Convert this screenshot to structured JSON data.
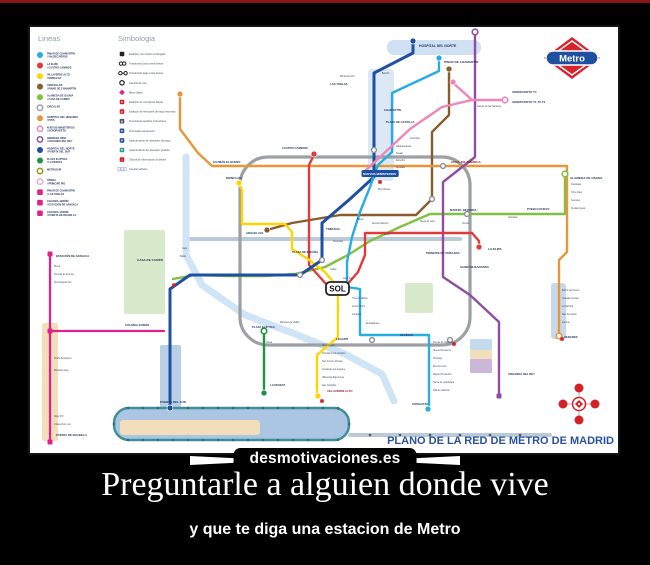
{
  "page": {
    "background": "#000000",
    "top_bar_color": "#8a1418"
  },
  "poster": {
    "watermark": "desmotivaciones.es",
    "caption_title": "Preguntarle a alguien donde vive",
    "caption_subtitle": "y que te diga una estacion de Metro"
  },
  "map": {
    "title": "PLANO DE LA RED DE METRO DE MADRID",
    "title_color": "#2a52a0",
    "logo_text": "Metro",
    "sol_label": "SOL",
    "legend_lines_header": "Lineas",
    "legend_symbols_header": "Simbologia",
    "legend_lines": [
      {
        "shape": "circle",
        "color": "#29ace3",
        "label": "PINAR DE CHAMARTÍN / VALDECARROS"
      },
      {
        "shape": "circle",
        "color": "#e23a3c",
        "label": "LA ELIPA / CUATRO CAMINOS"
      },
      {
        "shape": "circle",
        "color": "#ffd500",
        "label": "VILLAVERDE ALTO / MONCLOA"
      },
      {
        "shape": "circle",
        "color": "#8a5b2c",
        "label": "ARGÜELLES / PINAR DE CHAMARTÍN"
      },
      {
        "shape": "circle",
        "color": "#7fc241",
        "label": "ALAMEDA DE OSUNA / CASA DE CAMPO"
      },
      {
        "shape": "ring",
        "color": "#9ca0a3",
        "label": "CIRCULAR"
      },
      {
        "shape": "circle",
        "color": "#e8963c",
        "label": "HOSPITAL DEL HENARES / PITIS"
      },
      {
        "shape": "ring",
        "color": "#ef86b7",
        "label": "NUEVOS MINISTERIOS / AEROPUERTO"
      },
      {
        "shape": "ring",
        "color": "#8f4e9f",
        "label": "HERRERA ORIA / ARGANDA DEL REY"
      },
      {
        "shape": "circle",
        "color": "#1d50a1",
        "label": "HOSPITAL DEL NORTE / PUERTA DEL SUR"
      },
      {
        "shape": "circle",
        "color": "#1f9247",
        "label": "PLAZA ELÍPTICA / LA PESETA"
      },
      {
        "shape": "ring",
        "color": "#9b9013",
        "label": "METROSUR"
      },
      {
        "shape": "ring",
        "color": "#f0a8c8",
        "label": "ÓPERA / PRÍNCIPE PÍO"
      },
      {
        "shape": "square",
        "color": "#e0218a",
        "label": "PINAR DE CHAMARTÍN / LAS TABLAS"
      },
      {
        "shape": "square",
        "color": "#e0218a",
        "label": "COLONIA JARDÍN / ESTACIÓN DE ARAVACA"
      },
      {
        "shape": "square",
        "color": "#e0218a",
        "label": "COLONIA JARDÍN / PUERTA DE BOADILLA"
      }
    ],
    "legend_symbols": [
      {
        "icon": "blk",
        "color": "#222222",
        "label": "Estación con horario restringido"
      },
      {
        "icon": "xshort",
        "color": "#222222",
        "label": "Transbordo corto entre líneas"
      },
      {
        "icon": "xlong",
        "color": "#222222",
        "label": "Transbordo largo entre líneas"
      },
      {
        "icon": "swap",
        "color": "#222222",
        "label": "Cambio de tren"
      },
      {
        "icon": "ml",
        "color": "#e0218a",
        "label": "Metro ligero"
      },
      {
        "icon": "cerc",
        "color": "#d42027",
        "label": "Estación de Cercanías-Renfe"
      },
      {
        "icon": "rail",
        "color": "#d42027",
        "label": "Estación de ferrocarril de largo recorrido"
      },
      {
        "icon": "bus",
        "color": "#445566",
        "label": "Terminal de autobús interurbano"
      },
      {
        "icon": "air",
        "color": "#2a52a0",
        "label": "Terminales aeropuerto"
      },
      {
        "icon": "park",
        "color": "#2a52a0",
        "label": "Aparcamiento de disuasión de pago"
      },
      {
        "icon": "park",
        "color": "#2f9e8f",
        "label": "Aparcamiento de disuasión gratuito"
      },
      {
        "icon": "info",
        "color": "#d42027",
        "label": "Oficina de información al cliente"
      },
      {
        "icon": "tarif",
        "color": "#a9b2bf",
        "label": "Cambio tarifario"
      }
    ],
    "areas": [
      {
        "x": 338,
        "y": 42,
        "w": 26,
        "h": 112,
        "rx": 4,
        "fill": "#dce8f5"
      },
      {
        "x": 357,
        "y": 13,
        "w": 94,
        "h": 15,
        "rx": 7,
        "fill": "#cfe0f2"
      },
      {
        "x": 94,
        "y": 203,
        "w": 41,
        "h": 84,
        "rx": 2,
        "fill": "#d9e9cb"
      },
      {
        "x": 375,
        "y": 256,
        "w": 28,
        "h": 30,
        "rx": 2,
        "fill": "#d9e9cb"
      },
      {
        "x": 521,
        "y": 256,
        "w": 15,
        "h": 56,
        "rx": 3,
        "fill": "#c6daee"
      },
      {
        "x": 440,
        "y": 312,
        "w": 22,
        "h": 11,
        "rx": 1,
        "fill": "#c6daee"
      },
      {
        "x": 440,
        "y": 323,
        "w": 22,
        "h": 9,
        "rx": 1,
        "fill": "#f3debc"
      },
      {
        "x": 440,
        "y": 332,
        "w": 22,
        "h": 14,
        "rx": 1,
        "fill": "#cbb8d8"
      },
      {
        "x": 12,
        "y": 296,
        "w": 16,
        "h": 118,
        "rx": 2,
        "fill": "#f3debc"
      },
      {
        "x": 130,
        "y": 318,
        "w": 21,
        "h": 64,
        "rx": 2,
        "fill": "#b8cfe6"
      },
      {
        "x": 84,
        "y": 381,
        "w": 235,
        "h": 32,
        "rx": 15,
        "fill": "#abc6e2",
        "stroke": "#3f8e99",
        "sw": 2.5
      },
      {
        "x": 90,
        "y": 393,
        "w": 140,
        "h": 15,
        "rx": 3,
        "fill": "#f3debc"
      }
    ],
    "lines": [
      {
        "color": "#bcc9d8",
        "width": 4,
        "points": "160,212 430,212"
      },
      {
        "color": "#bcc9d8",
        "width": 4,
        "points": "320,408 520,408"
      },
      {
        "color": "#cfe4f4",
        "width": 7,
        "points": "156,130 156,228 172,258 215,288 265,307 315,327 352,347 364,374"
      },
      {
        "rect": [
          210,
          130,
          230,
          188
        ],
        "rx": 28,
        "color": "#9ca0a3",
        "width": 3.2
      },
      {
        "color": "#7fc241",
        "width": 2.4,
        "points": "535,148 535,187 437,187 400,187 370,200 340,214 318,228 295,240 265,247 235,249 200,249 165,248 143,252"
      },
      {
        "color": "#8a5b2c",
        "width": 2.4,
        "points": "419,43 419,88 402,105 402,172 386,188 310,188 262,196 237,203"
      },
      {
        "color": "#e8963c",
        "width": 2.4,
        "points": "150,68 150,102 168,126 182,139 537,139 537,225 529,233 529,308"
      },
      {
        "color": "#8f4e9f",
        "width": 2.4,
        "points": "445,5 445,130 413,155 413,250 440,268 469,295 469,368"
      },
      {
        "color": "#e23a3c",
        "width": 2.4,
        "points": "284,128 279,138 279,238 297,258 315,260 328,245 335,228 335,206 442,206 449,214 449,220"
      },
      {
        "color": "#ffd500",
        "width": 2.4,
        "points": "209,157 212,163 212,197 255,197 262,205 262,222 278,232 295,245 305,257 308,268 308,310 287,328 287,368"
      },
      {
        "color": "#1d50a1",
        "width": 3,
        "points": "383,15 383,26 344,46 344,150 320,172 292,196 292,233 270,248 160,248 140,262 140,381"
      },
      {
        "color": "#29ace3",
        "width": 2.4,
        "points": "409,32 409,44 362,66 362,125 348,138 340,160 330,185 322,210 317,235 317,260 330,262 330,308 399,308 399,381"
      },
      {
        "color": "#ef86b7",
        "width": 2.4,
        "points": "334,145 380,102 412,80 442,73 475,73"
      },
      {
        "color": "#ef86b7",
        "width": 2.4,
        "points": "442,73 430,62 423,56"
      },
      {
        "color": "#1f9247",
        "width": 2.4,
        "points": "234,305 234,365"
      },
      {
        "color": "#e0218a",
        "width": 2.2,
        "points": "20,228 20,415"
      },
      {
        "color": "#e0218a",
        "width": 2.2,
        "points": "20,304 134,304"
      }
    ],
    "markers": [
      {
        "x": 383,
        "y": 14,
        "type": "dot",
        "color": "#1d50a1"
      },
      {
        "x": 409,
        "y": 31,
        "type": "dot",
        "color": "#29ace3"
      },
      {
        "x": 419,
        "y": 42,
        "type": "dot",
        "color": "#8a5b2c"
      },
      {
        "x": 445,
        "y": 5,
        "type": "ring",
        "color": "#8f4e9f"
      },
      {
        "x": 150,
        "y": 67,
        "type": "dot",
        "color": "#e8963c"
      },
      {
        "x": 535,
        "y": 147,
        "type": "ring",
        "color": "#7fc241"
      },
      {
        "x": 475,
        "y": 73,
        "type": "ring",
        "color": "#ef86b7"
      },
      {
        "x": 423,
        "y": 55,
        "type": "dot",
        "color": "#ef86b7"
      },
      {
        "x": 449,
        "y": 220,
        "type": "dot",
        "color": "#e23a3c"
      },
      {
        "x": 284,
        "y": 127,
        "type": "dot",
        "color": "#e23a3c"
      },
      {
        "x": 209,
        "y": 156,
        "type": "dot",
        "color": "#ffd500"
      },
      {
        "x": 237,
        "y": 203,
        "type": "dot",
        "color": "#8a5b2c"
      },
      {
        "x": 288,
        "y": 369,
        "type": "dot",
        "color": "#ffd500"
      },
      {
        "x": 398,
        "y": 382,
        "type": "dot",
        "color": "#29ace3"
      },
      {
        "x": 234,
        "y": 304,
        "type": "ring",
        "color": "#1f9247"
      },
      {
        "x": 234,
        "y": 366,
        "type": "dot",
        "color": "#1f9247"
      },
      {
        "x": 469,
        "y": 369,
        "type": "square",
        "color": "#8f4e9f"
      },
      {
        "x": 529,
        "y": 309,
        "type": "ring",
        "color": "#e8963c"
      },
      {
        "x": 140,
        "y": 381,
        "type": "dot",
        "color": "#1d50a1"
      },
      {
        "x": 20,
        "y": 227,
        "type": "square",
        "color": "#e0218a"
      },
      {
        "x": 20,
        "y": 304,
        "type": "square",
        "color": "#e0218a"
      },
      {
        "x": 20,
        "y": 415,
        "type": "square",
        "color": "#e0218a"
      },
      {
        "x": 344,
        "y": 123,
        "type": "xfer"
      },
      {
        "x": 402,
        "y": 172,
        "type": "xfer"
      },
      {
        "x": 437,
        "y": 187,
        "type": "xfer"
      },
      {
        "x": 413,
        "y": 139,
        "type": "xfer"
      },
      {
        "x": 342,
        "y": 313,
        "type": "xfer"
      },
      {
        "x": 420,
        "y": 313,
        "type": "xfer"
      },
      {
        "x": 292,
        "y": 233,
        "type": "xfer"
      },
      {
        "x": 270,
        "y": 248,
        "type": "xfer"
      },
      {
        "x": 340,
        "y": 408,
        "type": "mini",
        "color": "#44586e"
      },
      {
        "x": 370,
        "y": 408,
        "type": "mini",
        "color": "#44586e"
      },
      {
        "x": 400,
        "y": 408,
        "type": "mini",
        "color": "#44586e"
      },
      {
        "x": 430,
        "y": 408,
        "type": "mini",
        "color": "#44586e"
      },
      {
        "x": 460,
        "y": 408,
        "type": "mini",
        "color": "#44586e"
      },
      {
        "x": 490,
        "y": 408,
        "type": "mini",
        "color": "#44586e"
      },
      {
        "x": 350,
        "y": 155,
        "type": "csq",
        "color": "#d42027"
      },
      {
        "x": 424,
        "y": 317,
        "type": "csq",
        "color": "#d42027"
      },
      {
        "x": 144,
        "y": 258,
        "type": "csq",
        "color": "#d42027"
      },
      {
        "x": 292,
        "y": 374,
        "type": "csq",
        "color": "#d42027"
      },
      {
        "x": 532,
        "y": 312,
        "type": "csq",
        "color": "#d42027"
      }
    ],
    "capsule_dots": {
      "y_top": 381,
      "y_bottom": 413,
      "x_start": 98,
      "x_end": 308,
      "step": 15,
      "color": "#2b6e78",
      "ends": [
        [
          84,
          397
        ],
        [
          319,
          397
        ]
      ]
    },
    "stations": [
      {
        "x": 389,
        "y": 20,
        "t": "HOSPITAL DEL NORTE",
        "s": 3.4
      },
      {
        "x": 414,
        "y": 36,
        "t": "PINAR DE CHAMARTÍN"
      },
      {
        "x": 300,
        "y": 58,
        "t": "LAS TABLAS",
        "s": 2.8
      },
      {
        "x": 354,
        "y": 84,
        "t": "CHAMARTÍN",
        "s": 2.8
      },
      {
        "x": 356,
        "y": 96,
        "t": "PLAZA DE CASTILLA",
        "s": 2.8
      },
      {
        "x": 482,
        "y": 66,
        "t": "AEROPUERTO T4",
        "s": 2.9
      },
      {
        "x": 482,
        "y": 76,
        "t": "AEROPUERTO T1-T2-T3",
        "s": 2.9
      },
      {
        "x": 333,
        "y": 148,
        "t": "NUEVOS MINISTERIOS",
        "s": 3,
        "badge": true
      },
      {
        "x": 421,
        "y": 136,
        "t": "AVDA. DE AMÉRICA",
        "c": "#8a1a1a"
      },
      {
        "x": 540,
        "y": 152,
        "t": "ALAMEDA DE OSUNA"
      },
      {
        "x": 497,
        "y": 183,
        "t": "PUEBLO NUEVO",
        "s": 2.8
      },
      {
        "x": 420,
        "y": 184,
        "t": "MANUEL BECERRA",
        "s": 2.8
      },
      {
        "x": 458,
        "y": 223,
        "t": "LA ELIPA"
      },
      {
        "x": 396,
        "y": 227,
        "t": "PRÍNCIPE DE VERGARA",
        "s": 2.9
      },
      {
        "x": 430,
        "y": 241,
        "t": "SAINZ DE BARANDA",
        "s": 2.9
      },
      {
        "x": 252,
        "y": 122,
        "t": "CUATRO CAMINOS",
        "s": 2.8
      },
      {
        "x": 183,
        "y": 136,
        "t": "GUZMÁN EL BUENO",
        "s": 2.8
      },
      {
        "x": 196,
        "y": 152,
        "t": "MONCLOA"
      },
      {
        "x": 216,
        "y": 207,
        "t": "ARGÜELLES",
        "s": 2.8
      },
      {
        "x": 262,
        "y": 226,
        "t": "PLAZA DE ESPAÑA",
        "s": 2.8
      },
      {
        "x": 296,
        "y": 203,
        "t": "TRIBUNAL",
        "s": 2.8
      },
      {
        "x": 107,
        "y": 234,
        "t": "CASA DE CAMPO"
      },
      {
        "x": 95,
        "y": 299,
        "t": "COLONIA JARDÍN",
        "s": 2.8
      },
      {
        "x": 26,
        "y": 230,
        "t": "ESTACIÓN DE ARAVACA",
        "s": 2.8
      },
      {
        "x": 26,
        "y": 409,
        "t": "PUERTA DE BOADILLA",
        "s": 2.8
      },
      {
        "x": 130,
        "y": 376,
        "t": "PUERTA DEL SUR",
        "s": 3
      },
      {
        "x": 297,
        "y": 365,
        "t": "VILLAVERDE ALTO",
        "s": 2.8,
        "c": "#8a1a1a"
      },
      {
        "x": 240,
        "y": 359,
        "t": "LA PESETA",
        "s": 2.8
      },
      {
        "x": 478,
        "y": 348,
        "t": "ARGANDA DEL REY",
        "s": 2.8
      },
      {
        "x": 534,
        "y": 311,
        "t": "HENARES",
        "s": 2.8
      },
      {
        "x": 370,
        "y": 309,
        "t": "PACÍFICO",
        "s": 2.8
      },
      {
        "x": 306,
        "y": 313,
        "t": "LEGAZPI",
        "s": 2.8
      },
      {
        "x": 222,
        "y": 301,
        "t": "PLAZA ELÍPTICA",
        "s": 2.8
      },
      {
        "x": 382,
        "y": 378,
        "t": "CONGOSTO",
        "s": 2.8
      }
    ],
    "minor_stations": [
      [
        366,
        120,
        "Valdeacederas"
      ],
      [
        366,
        127,
        "Tetuán"
      ],
      [
        366,
        134,
        "Estrecho"
      ],
      [
        366,
        141,
        "Alvarado"
      ],
      [
        348,
        163,
        "Ríos Rosas"
      ],
      [
        327,
        193,
        "Bilbao"
      ],
      [
        303,
        215,
        "Noviciado"
      ],
      [
        300,
        243,
        "Callao"
      ],
      [
        313,
        252,
        "Gran Vía"
      ],
      [
        342,
        197,
        "Alonso Martínez"
      ],
      [
        354,
        208,
        "Colón"
      ],
      [
        390,
        195,
        "Diego de León"
      ],
      [
        432,
        197,
        "Ventas"
      ],
      [
        478,
        191,
        "Quintana"
      ],
      [
        541,
        158,
        "Canillejas"
      ],
      [
        541,
        166,
        "Torre Arias"
      ],
      [
        541,
        174,
        "Suanzes"
      ],
      [
        541,
        182,
        "Ciudad Lineal"
      ],
      [
        322,
        272,
        "Tirso de Molina"
      ],
      [
        322,
        280,
        "Antón Martín"
      ],
      [
        322,
        288,
        "Lavapiés"
      ],
      [
        336,
        297,
        "Embajadores"
      ],
      [
        403,
        316,
        "Puente de Vallecas"
      ],
      [
        403,
        324,
        "Nueva Numancia"
      ],
      [
        403,
        332,
        "Portazgo"
      ],
      [
        403,
        340,
        "Buenos Aires"
      ],
      [
        403,
        348,
        "Miguel Hernández"
      ],
      [
        403,
        356,
        "Sierra de Guadalupe"
      ],
      [
        403,
        364,
        "Villa de Vallecas"
      ],
      [
        292,
        319,
        "Almendrales"
      ],
      [
        292,
        327,
        "Hospital 12 de Octubre"
      ],
      [
        292,
        335,
        "San Fermín-Orcasur"
      ],
      [
        292,
        343,
        "Ciudad de los Ángeles"
      ],
      [
        292,
        351,
        "Villaverde Bajo-Cruce"
      ],
      [
        292,
        359,
        "San Cristóbal"
      ],
      [
        24,
        240,
        "Berna"
      ],
      [
        24,
        248,
        "Avenida de Europa"
      ],
      [
        24,
        256,
        "Somosaguas Sur"
      ],
      [
        24,
        332,
        "Prado del Espino"
      ],
      [
        24,
        344,
        "Montepríncipe"
      ],
      [
        24,
        390,
        "Siglo XXI"
      ],
      [
        24,
        398,
        "Infante Don Luis"
      ],
      [
        532,
        264,
        "Barrio del Puerto"
      ],
      [
        532,
        272,
        "Coslada Central"
      ],
      [
        532,
        280,
        "La Rambla"
      ],
      [
        532,
        288,
        "San Fernando"
      ],
      [
        532,
        296,
        "Jarama"
      ],
      [
        447,
        80,
        "Campo de las Naciones"
      ],
      [
        380,
        112,
        "Colombia"
      ],
      [
        352,
        47,
        "Bambú"
      ],
      [
        310,
        50,
        "Montecarmelo"
      ],
      [
        150,
        230,
        "Batán"
      ],
      [
        152,
        222,
        "Lago"
      ],
      [
        236,
        316,
        "Usera"
      ],
      [
        250,
        296,
        "Marqués de Vadillo"
      ]
    ],
    "compass": {
      "cx": 549,
      "cy": 377,
      "color": "#d42027"
    },
    "logo": {
      "red": "#d8232a",
      "blue": "#1f4fa0"
    }
  }
}
